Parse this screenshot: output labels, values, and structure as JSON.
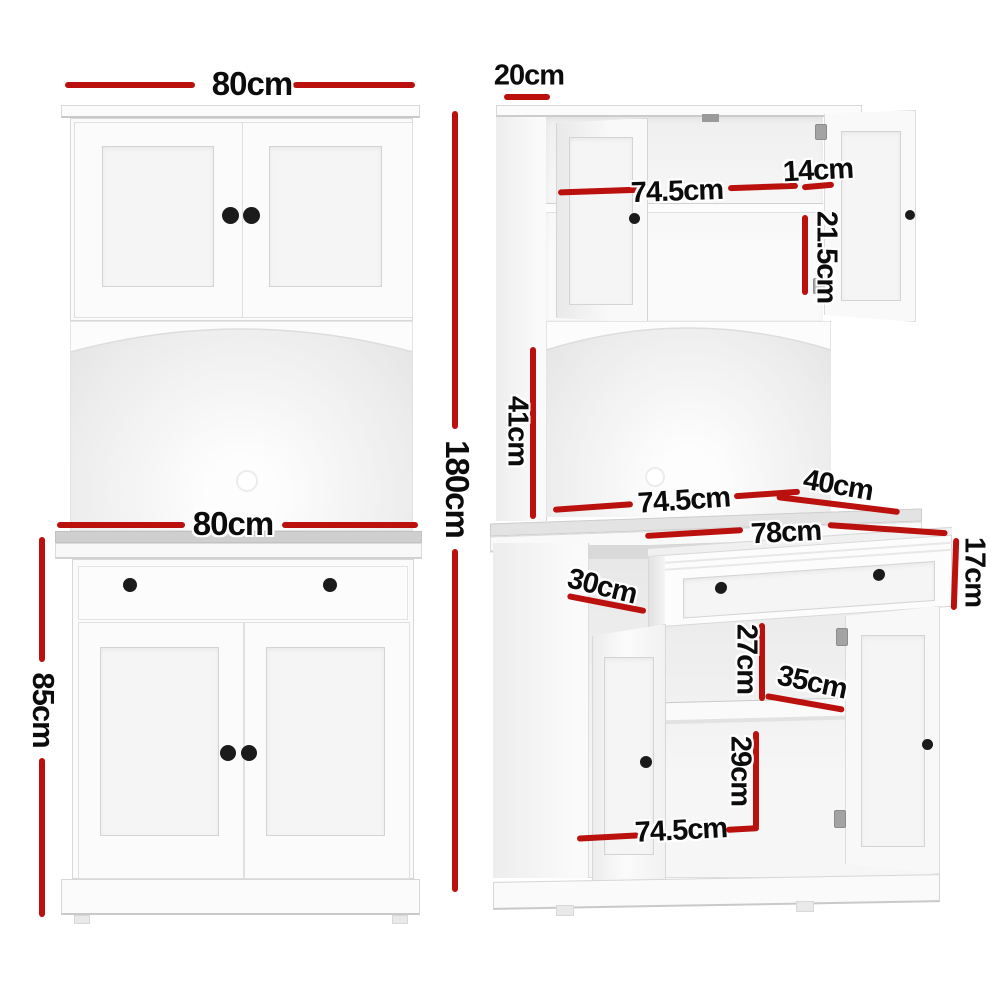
{
  "image_type": "furniture product dimension diagram",
  "product": "white buffet sideboard cabinet with hutch",
  "colors": {
    "background": "#ffffff",
    "dimension_red": "#ba100e",
    "dimension_text": "#0c0c0c",
    "cabinet_white": "#fbfbfb",
    "edge_gray": "#d8d8d8",
    "counter_gray": "#cfcfcf",
    "knob_black": "#1b1b1b",
    "hinge_gray": "#a3a3a3"
  },
  "views": {
    "front": {
      "name": "front closed view",
      "dimensions": [
        {
          "id": "top-width",
          "label": "80cm"
        },
        {
          "id": "overall-height",
          "label": "180cm"
        },
        {
          "id": "counter-width",
          "label": "80cm"
        },
        {
          "id": "base-height",
          "label": "85cm"
        }
      ]
    },
    "open": {
      "name": "angled open view",
      "dimensions": [
        {
          "id": "top-depth",
          "label": "20cm"
        },
        {
          "id": "hutch-interior-width",
          "label": "74.5cm"
        },
        {
          "id": "hutch-door-depth",
          "label": "14cm"
        },
        {
          "id": "hutch-shelf-height",
          "label": "21.5cm"
        },
        {
          "id": "middle-open-height",
          "label": "41cm"
        },
        {
          "id": "middle-interior-width",
          "label": "74.5cm"
        },
        {
          "id": "counter-depth",
          "label": "40cm"
        },
        {
          "id": "drawer-width",
          "label": "78cm"
        },
        {
          "id": "drawer-height",
          "label": "17cm"
        },
        {
          "id": "base-depth",
          "label": "30cm"
        },
        {
          "id": "above-shelf-clearance",
          "label": "27cm"
        },
        {
          "id": "shelf-depth",
          "label": "35cm"
        },
        {
          "id": "below-shelf-clearance",
          "label": "29cm"
        },
        {
          "id": "base-interior-width",
          "label": "74.5cm"
        }
      ]
    }
  }
}
